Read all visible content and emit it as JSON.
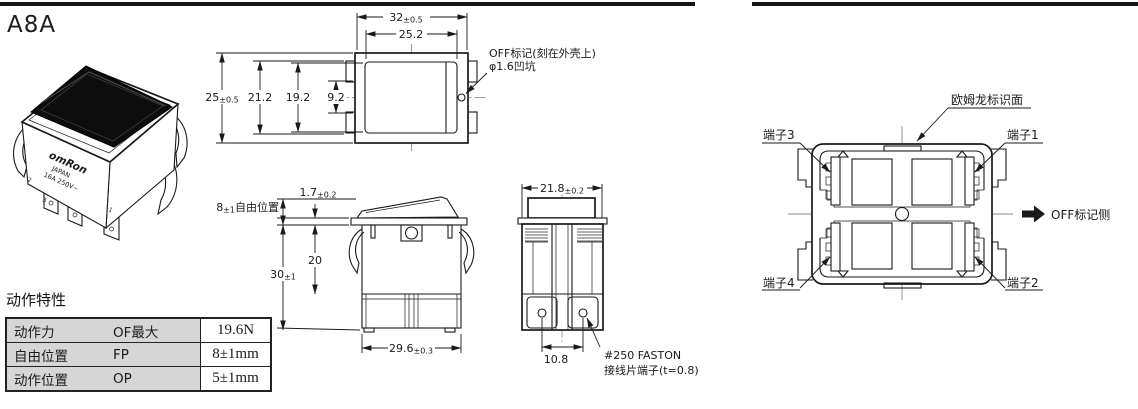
{
  "header": {
    "model": "A8A"
  },
  "product": {
    "brand": "omRon",
    "origin": "JAPAN",
    "rating": "16A 250V~",
    "marks": {
      "m2": "2",
      "m3": "3",
      "m1": "1"
    }
  },
  "top_view": {
    "dims": {
      "w_outer": {
        "v": "32",
        "t": "±0.5"
      },
      "w_inner": {
        "v": "25.2"
      },
      "h_outer": {
        "v": "25",
        "t": "±0.5"
      },
      "h_tab": {
        "v": "21.2"
      },
      "h_inner": {
        "v": "19.2"
      },
      "h_center": {
        "v": "9.2"
      }
    },
    "callout": {
      "line1": "OFF标记(刻在外壳上)",
      "line2": "φ1.6凹坑"
    }
  },
  "side_view": {
    "dims": {
      "protrusion": {
        "v": "1.7",
        "t": "±0.2"
      },
      "free_pos": {
        "v": "8",
        "t": "±1",
        "s": "自由位置"
      },
      "height": {
        "v": "30",
        "t": "±1"
      },
      "body": {
        "v": "20"
      },
      "width": {
        "v": "29.6",
        "t": "±0.3"
      }
    }
  },
  "end_view": {
    "dims": {
      "w": {
        "v": "21.8",
        "t": "±0.2"
      },
      "pitch": {
        "v": "10.8"
      }
    },
    "callout": {
      "line1": "#250 FASTON",
      "line2": "接线片端子(t=0.8)"
    }
  },
  "bottom_view": {
    "brand_face": "欧姆龙标识面",
    "t1": "端子1",
    "t2": "端子2",
    "t3": "端子3",
    "t4": "端子4",
    "off_side": "OFF标记侧"
  },
  "spec_table": {
    "title": "动作特性",
    "rows": [
      {
        "label": "动作力",
        "code": "OF最大",
        "value": "19.6N"
      },
      {
        "label": "自由位置",
        "code": "FP",
        "value": "8±1mm"
      },
      {
        "label": "动作位置",
        "code": "OP",
        "value": "5±1mm"
      }
    ]
  },
  "colors": {
    "line": "#1a1a1a",
    "table_gray": "#d6d6d6",
    "rule": "#161616"
  }
}
